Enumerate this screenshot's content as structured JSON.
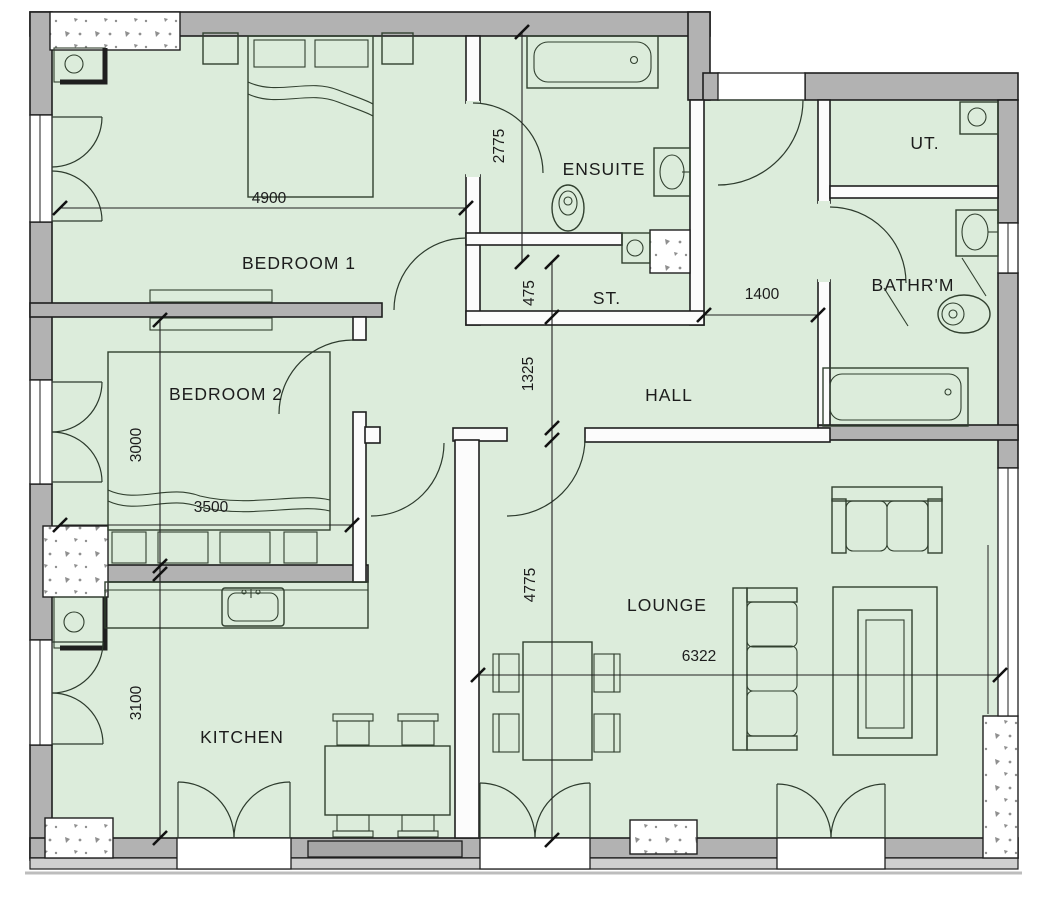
{
  "plan": {
    "type": "bungalow-floor-plan",
    "colors": {
      "floor": "#dcecdb",
      "exterior_wall": "#b2b2b2",
      "partition_wall": "#fcfcfc",
      "outline": "#1f1f1f",
      "furniture_line": "#31402f"
    },
    "rooms": {
      "bedroom1": {
        "label": "BEDROOM 1"
      },
      "bedroom2": {
        "label": "BEDROOM 2"
      },
      "ensuite": {
        "label": "ENSUITE"
      },
      "store": {
        "label": "ST."
      },
      "hall": {
        "label": "HALL"
      },
      "utility": {
        "label": "UT."
      },
      "bathroom": {
        "label": "BATHR'M"
      },
      "lounge": {
        "label": "LOUNGE"
      },
      "kitchen": {
        "label": "KITCHEN"
      }
    },
    "dimensions_mm": {
      "bedroom1_width": {
        "label": "4900"
      },
      "ensuite_depth": {
        "label": "2775"
      },
      "store_depth": {
        "label": "475"
      },
      "hall_depth": {
        "label": "1325"
      },
      "hall_to_bath": {
        "label": "1400"
      },
      "bedroom2_depth": {
        "label": "3000"
      },
      "bedroom2_width": {
        "label": "3500"
      },
      "kitchen_depth": {
        "label": "3100"
      },
      "lounge_depth": {
        "label": "4775"
      },
      "lounge_width": {
        "label": "6322"
      }
    }
  }
}
